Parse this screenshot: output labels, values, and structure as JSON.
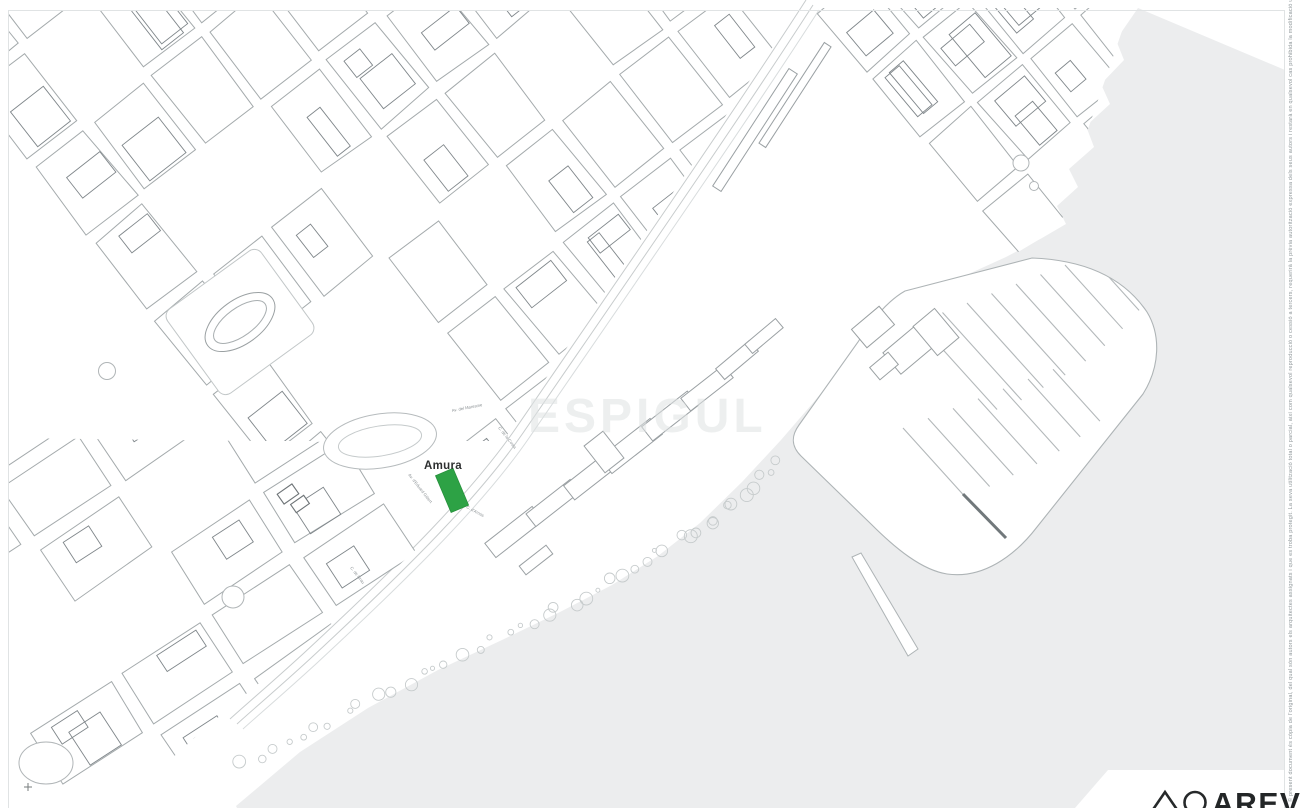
{
  "plan": {
    "highlight": {
      "label": "Amura",
      "color": "#2da245"
    },
    "watermark": {
      "text": "ESPIGUL"
    },
    "streets": [
      {
        "name": "Av. del Maresme"
      },
      {
        "name": "C. de la Costa"
      },
      {
        "name": "Av. d'Eduard Gibert"
      },
      {
        "name": "C. d'Arnús"
      },
      {
        "name": "C. de Grau"
      }
    ],
    "margin_note": "© present document és còpia de l'original, del qual són autors els arquitectes assignats i que es troba protegit. La seva utilització total o parcial, així com qualsevol reproducció o cessió a tercers, requerirà la prèvia autorització expressa dels seus autors i restarà en qualsevol cas prohibida la modificació unilateral del mateix.",
    "logo": {
      "wordmark": "AREV"
    },
    "colors": {
      "sea": "#ecedee",
      "line_light": "#b9bec0",
      "line_dark": "#7e8588"
    }
  }
}
